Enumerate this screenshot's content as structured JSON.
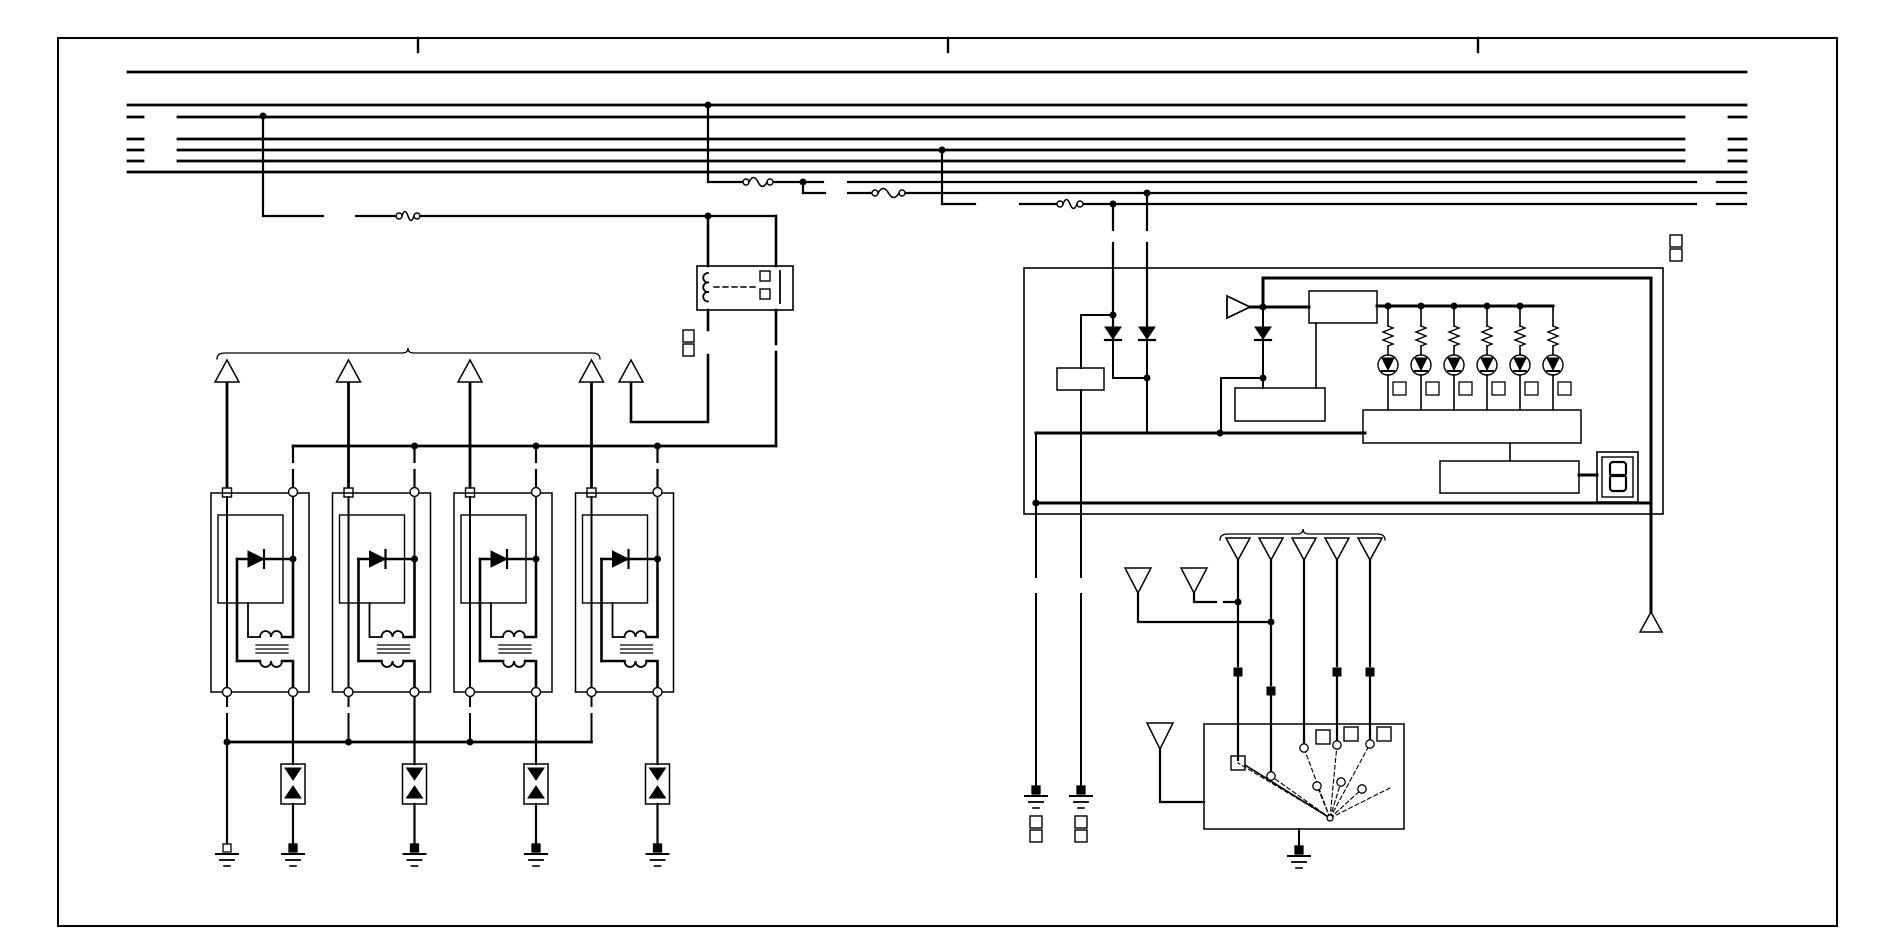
{
  "canvas": {
    "width": 1900,
    "height": 950,
    "background": "#ffffff",
    "ink": "#000000"
  },
  "border": {
    "x": 58,
    "y": 38,
    "w": 1779,
    "h": 888,
    "stroke": 2,
    "tick_xs": [
      418,
      948,
      1478
    ],
    "tick_len": 14
  },
  "bus": {
    "rows": [
      {
        "y": 72,
        "w": 2.8,
        "segs": [
          [
            128,
            1746
          ]
        ]
      },
      {
        "y": 105,
        "w": 2.8,
        "segs": [
          [
            128,
            1746
          ]
        ]
      },
      {
        "y": 117,
        "w": 2.8,
        "segs": [
          [
            128,
            143
          ],
          [
            178,
            1684
          ],
          [
            1729,
            1746
          ]
        ]
      },
      {
        "y": 139,
        "w": 2.8,
        "segs": [
          [
            128,
            143
          ],
          [
            178,
            1684
          ],
          [
            1729,
            1746
          ]
        ]
      },
      {
        "y": 150,
        "w": 2.8,
        "segs": [
          [
            128,
            143
          ],
          [
            178,
            1684
          ],
          [
            1729,
            1746
          ]
        ]
      },
      {
        "y": 161,
        "w": 2.8,
        "segs": [
          [
            128,
            143
          ],
          [
            178,
            1684
          ],
          [
            1729,
            1746
          ]
        ]
      },
      {
        "y": 172,
        "w": 2.8,
        "segs": [
          [
            128,
            1746
          ]
        ]
      },
      {
        "y": 182,
        "w": 2.2,
        "segs": [
          [
            709,
            743
          ],
          [
            773,
            823
          ],
          [
            848,
            1696
          ],
          [
            1717,
            1746
          ]
        ]
      },
      {
        "y": 193,
        "w": 2.2,
        "segs": [
          [
            803,
            825
          ],
          [
            848,
            872
          ],
          [
            905,
            1746
          ]
        ]
      },
      {
        "y": 204,
        "w": 2.2,
        "segs": [
          [
            942,
            975
          ],
          [
            1020,
            1057
          ],
          [
            1083,
            1696
          ],
          [
            1717,
            1746
          ]
        ]
      }
    ]
  },
  "fuses": [
    {
      "y": 182,
      "x1": 743,
      "x2": 773
    },
    {
      "y": 193,
      "x1": 872,
      "x2": 905
    },
    {
      "y": 204,
      "x1": 1057,
      "x2": 1083
    },
    {
      "y": 216,
      "x1": 396,
      "x2": 420
    }
  ],
  "wires": [
    {
      "w": 2.2,
      "p": [
        [
          263,
          116
        ],
        [
          263,
          216
        ]
      ]
    },
    {
      "w": 2.2,
      "p": [
        [
          263,
          216
        ],
        [
          323,
          216
        ]
      ]
    },
    {
      "w": 2.2,
      "p": [
        [
          356,
          216
        ],
        [
          396,
          216
        ]
      ]
    },
    {
      "w": 2.2,
      "p": [
        [
          420,
          216
        ],
        [
          776,
          216
        ]
      ]
    },
    {
      "w": 2.2,
      "p": [
        [
          708,
          105
        ],
        [
          708,
          182
        ]
      ]
    },
    {
      "w": 2.2,
      "p": [
        [
          942,
          150
        ],
        [
          942,
          204
        ]
      ]
    },
    {
      "w": 2.2,
      "p": [
        [
          803,
          182
        ],
        [
          803,
          193
        ]
      ]
    },
    {
      "w": 2.6,
      "p": [
        [
          708,
          216
        ],
        [
          708,
          266
        ]
      ]
    },
    {
      "w": 2.6,
      "p": [
        [
          776,
          216
        ],
        [
          776,
          266
        ]
      ]
    },
    {
      "w": 2.6,
      "p": [
        [
          708,
          310
        ],
        [
          708,
          330
        ]
      ]
    },
    {
      "w": 2.6,
      "p": [
        [
          708,
          355
        ],
        [
          708,
          422
        ],
        [
          631,
          422
        ],
        [
          631,
          383
        ]
      ]
    },
    {
      "w": 2.6,
      "p": [
        [
          776,
          310
        ],
        [
          776,
          344
        ]
      ]
    },
    {
      "w": 2.6,
      "p": [
        [
          776,
          352
        ],
        [
          776,
          446
        ]
      ]
    },
    {
      "w": 2.8,
      "p": [
        [
          293,
          446
        ],
        [
          776,
          446
        ]
      ]
    },
    {
      "w": 2.2,
      "p": [
        [
          293,
          446
        ],
        [
          293,
          462
        ]
      ]
    },
    {
      "w": 2.2,
      "p": [
        [
          293,
          470
        ],
        [
          293,
          488
        ]
      ]
    },
    {
      "w": 2.2,
      "p": [
        [
          414.5,
          446
        ],
        [
          414.5,
          462
        ]
      ]
    },
    {
      "w": 2.2,
      "p": [
        [
          414.5,
          470
        ],
        [
          414.5,
          488
        ]
      ]
    },
    {
      "w": 2.2,
      "p": [
        [
          536,
          446
        ],
        [
          536,
          462
        ]
      ]
    },
    {
      "w": 2.2,
      "p": [
        [
          536,
          470
        ],
        [
          536,
          488
        ]
      ]
    },
    {
      "w": 2.2,
      "p": [
        [
          657.5,
          446
        ],
        [
          657.5,
          462
        ]
      ]
    },
    {
      "w": 2.2,
      "p": [
        [
          657.5,
          470
        ],
        [
          657.5,
          488
        ]
      ]
    },
    {
      "w": 2.8,
      "p": [
        [
          227,
          742
        ],
        [
          591.5,
          742
        ]
      ]
    },
    {
      "w": 2.2,
      "p": [
        [
          227,
          742
        ],
        [
          227,
          844
        ]
      ]
    },
    {
      "w": 2.2,
      "p": [
        [
          1113,
          204
        ],
        [
          1113,
          230
        ]
      ]
    },
    {
      "w": 2.2,
      "p": [
        [
          1113,
          243
        ],
        [
          1113,
          327
        ]
      ]
    },
    {
      "w": 2.2,
      "p": [
        [
          1147,
          193
        ],
        [
          1147,
          230
        ]
      ]
    },
    {
      "w": 2.2,
      "p": [
        [
          1147,
          243
        ],
        [
          1147,
          327
        ]
      ]
    },
    {
      "w": 2,
      "p": [
        [
          1113,
          340
        ],
        [
          1113,
          378
        ],
        [
          1147,
          378
        ]
      ]
    },
    {
      "w": 2,
      "p": [
        [
          1147,
          340
        ],
        [
          1147,
          433
        ]
      ]
    },
    {
      "w": 2,
      "p": [
        [
          1113,
          315
        ],
        [
          1081,
          315
        ],
        [
          1081,
          368
        ]
      ]
    },
    {
      "w": 2,
      "p": [
        [
          1081,
          390
        ],
        [
          1081,
          577
        ]
      ]
    },
    {
      "w": 2,
      "p": [
        [
          1081,
          594
        ],
        [
          1081,
          786
        ]
      ]
    },
    {
      "w": 2,
      "p": [
        [
          1036,
          433
        ],
        [
          1036,
          577
        ]
      ]
    },
    {
      "w": 2,
      "p": [
        [
          1036,
          594
        ],
        [
          1036,
          786
        ]
      ]
    },
    {
      "w": 3,
      "p": [
        [
          1036,
          433
        ],
        [
          1365,
          433
        ]
      ]
    },
    {
      "w": 3,
      "p": [
        [
          1034,
          503
        ],
        [
          1651,
          503
        ]
      ]
    },
    {
      "w": 3,
      "p": [
        [
          1263,
          307
        ],
        [
          1263,
          278
        ],
        [
          1651,
          278
        ],
        [
          1651,
          612
        ]
      ]
    },
    {
      "w": 2,
      "p": [
        [
          1263,
          307
        ],
        [
          1263,
          327
        ]
      ]
    },
    {
      "w": 2,
      "p": [
        [
          1263,
          340
        ],
        [
          1263,
          388
        ]
      ]
    },
    {
      "w": 2,
      "p": [
        [
          1263,
          378
        ],
        [
          1221,
          378
        ],
        [
          1221,
          433
        ]
      ]
    },
    {
      "w": 3,
      "p": [
        [
          1250,
          307
        ],
        [
          1309,
          307
        ]
      ]
    },
    {
      "w": 1.6,
      "p": [
        [
          1316,
          323
        ],
        [
          1316,
          388
        ]
      ]
    },
    {
      "w": 3,
      "p": [
        [
          1377,
          306
        ],
        [
          1553,
          306
        ]
      ]
    },
    {
      "w": 1.6,
      "p": [
        [
          1510,
          443
        ],
        [
          1510,
          461
        ]
      ]
    },
    {
      "w": 3,
      "p": [
        [
          1579,
          475
        ],
        [
          1597,
          475
        ]
      ]
    },
    {
      "w": 2.2,
      "p": [
        [
          1238,
          560
        ],
        [
          1238,
          666
        ]
      ]
    },
    {
      "w": 2.2,
      "p": [
        [
          1238,
          676
        ],
        [
          1238,
          760
        ]
      ]
    },
    {
      "w": 2.2,
      "p": [
        [
          1271,
          560
        ],
        [
          1271,
          685
        ]
      ]
    },
    {
      "w": 2.2,
      "p": [
        [
          1271,
          695
        ],
        [
          1271,
          772
        ]
      ]
    },
    {
      "w": 2.2,
      "p": [
        [
          1304,
          560
        ],
        [
          1304,
          744
        ]
      ]
    },
    {
      "w": 2.2,
      "p": [
        [
          1337,
          560
        ],
        [
          1337,
          666
        ]
      ]
    },
    {
      "w": 2.2,
      "p": [
        [
          1337,
          676
        ],
        [
          1337,
          741
        ]
      ]
    },
    {
      "w": 2.2,
      "p": [
        [
          1370,
          560
        ],
        [
          1370,
          666
        ]
      ]
    },
    {
      "w": 2.2,
      "p": [
        [
          1370,
          676
        ],
        [
          1370,
          740
        ]
      ]
    },
    {
      "w": 2.2,
      "p": [
        [
          1138,
          593
        ],
        [
          1138,
          622
        ],
        [
          1271,
          622
        ]
      ]
    },
    {
      "w": 2.2,
      "p": [
        [
          1194,
          593
        ],
        [
          1194,
          602
        ],
        [
          1216,
          602
        ]
      ]
    },
    {
      "w": 2.2,
      "p": [
        [
          1224,
          602
        ],
        [
          1238,
          602
        ]
      ]
    },
    {
      "w": 2.2,
      "p": [
        [
          1160,
          749
        ],
        [
          1160,
          802
        ],
        [
          1204,
          802
        ]
      ]
    },
    {
      "w": 2,
      "p": [
        [
          1299,
          829
        ],
        [
          1299,
          846
        ]
      ]
    }
  ],
  "dots": [
    [
      263,
      116
    ],
    [
      708,
      105
    ],
    [
      942,
      150
    ],
    [
      803,
      182
    ],
    [
      708,
      216
    ],
    [
      1113,
      204
    ],
    [
      1147,
      193
    ],
    [
      414.5,
      446
    ],
    [
      536,
      446
    ],
    [
      657.5,
      446
    ],
    [
      227,
      742
    ],
    [
      348.5,
      742
    ],
    [
      470,
      742
    ],
    [
      1113,
      315
    ],
    [
      1147,
      378
    ],
    [
      1263,
      307
    ],
    [
      1263,
      378
    ],
    [
      1220,
      433
    ],
    [
      1036,
      503
    ],
    [
      1388,
      306
    ],
    [
      1421,
      306
    ],
    [
      1454,
      306
    ],
    [
      1487,
      306
    ],
    [
      1520,
      306
    ],
    [
      1238,
      602
    ],
    [
      1271,
      622
    ]
  ],
  "connector_markers": [
    [
      1234,
      668,
      8,
      8
    ],
    [
      1267,
      687,
      8,
      8
    ],
    [
      1333,
      668,
      8,
      8
    ],
    [
      1366,
      668,
      8,
      8
    ]
  ],
  "label_squares": [
    [
      683,
      330,
      11,
      12
    ],
    [
      683,
      344,
      11,
      12
    ],
    [
      1670,
      235,
      12,
      12
    ],
    [
      1670,
      249,
      12,
      12
    ],
    [
      1030,
      816,
      12,
      12
    ],
    [
      1030,
      830,
      12,
      12
    ],
    [
      1075,
      816,
      12,
      12
    ],
    [
      1075,
      830,
      12,
      12
    ]
  ],
  "braces": [
    {
      "x1": 217,
      "x2": 600,
      "y": 353,
      "tick": 408
    },
    {
      "x1": 1220,
      "x2": 1385,
      "y": 534,
      "tick": 1303
    }
  ],
  "triangles_up": [
    {
      "cx": 227,
      "y": 360,
      "h": 22,
      "hw": 12
    },
    {
      "cx": 348.5,
      "y": 360,
      "h": 22,
      "hw": 12
    },
    {
      "cx": 470,
      "y": 360,
      "h": 22,
      "hw": 12
    },
    {
      "cx": 591.5,
      "y": 360,
      "h": 22,
      "hw": 12
    },
    {
      "cx": 631,
      "y": 360,
      "h": 22,
      "hw": 12
    },
    {
      "cx": 1651,
      "y": 612,
      "h": 20,
      "hw": 11
    }
  ],
  "triangles_down": [
    {
      "cx": 1238,
      "y": 538,
      "h": 22,
      "hw": 12
    },
    {
      "cx": 1271,
      "y": 538,
      "h": 22,
      "hw": 12
    },
    {
      "cx": 1304,
      "y": 538,
      "h": 22,
      "hw": 12
    },
    {
      "cx": 1337,
      "y": 538,
      "h": 22,
      "hw": 12
    },
    {
      "cx": 1370,
      "y": 538,
      "h": 22,
      "hw": 12
    },
    {
      "cx": 1138,
      "y": 568,
      "h": 25,
      "hw": 13
    },
    {
      "cx": 1194,
      "y": 568,
      "h": 25,
      "hw": 13
    },
    {
      "cx": 1160,
      "y": 723,
      "h": 26,
      "hw": 13
    }
  ],
  "grounds": [
    {
      "x": 227,
      "y": 844,
      "open": true
    },
    {
      "x": 293,
      "y": 844,
      "open": false
    },
    {
      "x": 414.5,
      "y": 844,
      "open": false
    },
    {
      "x": 536,
      "y": 844,
      "open": false
    },
    {
      "x": 657.5,
      "y": 844,
      "open": false
    },
    {
      "x": 1036,
      "y": 786,
      "open": false
    },
    {
      "x": 1081,
      "y": 786,
      "open": false
    },
    {
      "x": 1299,
      "y": 846,
      "open": false
    }
  ],
  "relay": {
    "x": 697,
    "y": 266,
    "w": 96,
    "h": 44,
    "coil_x": 708,
    "coil_y": 273,
    "bar_x": 780,
    "sq": [
      [
        760,
        271,
        10,
        10
      ],
      [
        760,
        289,
        10,
        10
      ]
    ],
    "dash": [
      714,
      287,
      758,
      287
    ]
  },
  "coil_blocks": {
    "count": 4,
    "ox": 211,
    "oy": 493,
    "pitch": 121.5,
    "w": 98,
    "h": 199,
    "inner": [
      7,
      22,
      65,
      88
    ],
    "lpin": 16,
    "rpin": 82,
    "zener": {
      "dy_top": 204,
      "w": 24,
      "h": 40
    },
    "drop_bus_y": 742,
    "ground_y": 844
  },
  "cluster": {
    "box": {
      "x": 1024,
      "y": 268,
      "w": 639,
      "h": 246
    },
    "r1": {
      "x": 1057,
      "y": 368,
      "w": 47,
      "h": 22
    },
    "b1": {
      "x": 1309,
      "y": 291,
      "w": 68,
      "h": 32
    },
    "b2": {
      "x": 1235,
      "y": 388,
      "w": 90,
      "h": 33
    },
    "w1": {
      "x": 1363,
      "y": 410,
      "w": 218,
      "h": 33
    },
    "w2": {
      "x": 1440,
      "y": 461,
      "w": 139,
      "h": 32
    },
    "buffer": {
      "x": 1227,
      "y1": 296,
      "y2": 318,
      "tip_x": 1250
    },
    "diodes_down": [
      [
        1113,
        327
      ],
      [
        1147,
        327
      ],
      [
        1263,
        327
      ]
    ],
    "vbreaks": [
      [
        1113,
        230,
        1113,
        243
      ],
      [
        1147,
        230,
        1147,
        243
      ]
    ]
  },
  "led_branches": {
    "xs": [
      1388,
      1421,
      1454,
      1487,
      1520,
      1553
    ],
    "rail_y": 306,
    "res_y1": 326,
    "res_y2": 346,
    "led_cy": 365,
    "led_r": 10,
    "sq_y": 382,
    "sq_w": 13,
    "sq_h": 13,
    "end_y": 410
  },
  "seven_seg": {
    "outer": [
      1597,
      452,
      41,
      50
    ],
    "inner": [
      1602,
      457,
      31,
      40
    ],
    "digit": "8",
    "loops": [
      [
        1610,
        462,
        16,
        14
      ],
      [
        1610,
        475,
        16,
        16
      ]
    ]
  },
  "rotary": {
    "box": {
      "x": 1204,
      "y": 724,
      "w": 200,
      "h": 105
    },
    "pivot": [
      1330,
      818
    ],
    "contacts_circ": [
      [
        1271,
        776
      ],
      [
        1304,
        748
      ],
      [
        1337,
        745
      ],
      [
        1370,
        744
      ],
      [
        1317,
        786
      ],
      [
        1341,
        782
      ],
      [
        1362,
        789
      ]
    ],
    "contact_sq": [
      1231,
      756,
      14,
      14
    ],
    "squares": [
      [
        1316,
        730,
        14,
        14
      ],
      [
        1344,
        727,
        14,
        14
      ],
      [
        1377,
        727,
        14,
        14
      ]
    ],
    "wiper": [
      [
        1245,
        765
      ],
      [
        1330,
        818
      ]
    ],
    "rays": [
      [
        1238,
        763
      ],
      [
        1271,
        776
      ],
      [
        1304,
        748
      ],
      [
        1337,
        745
      ],
      [
        1370,
        744
      ],
      [
        1390,
        788
      ],
      [
        1317,
        786
      ],
      [
        1341,
        782
      ],
      [
        1362,
        789
      ]
    ]
  }
}
